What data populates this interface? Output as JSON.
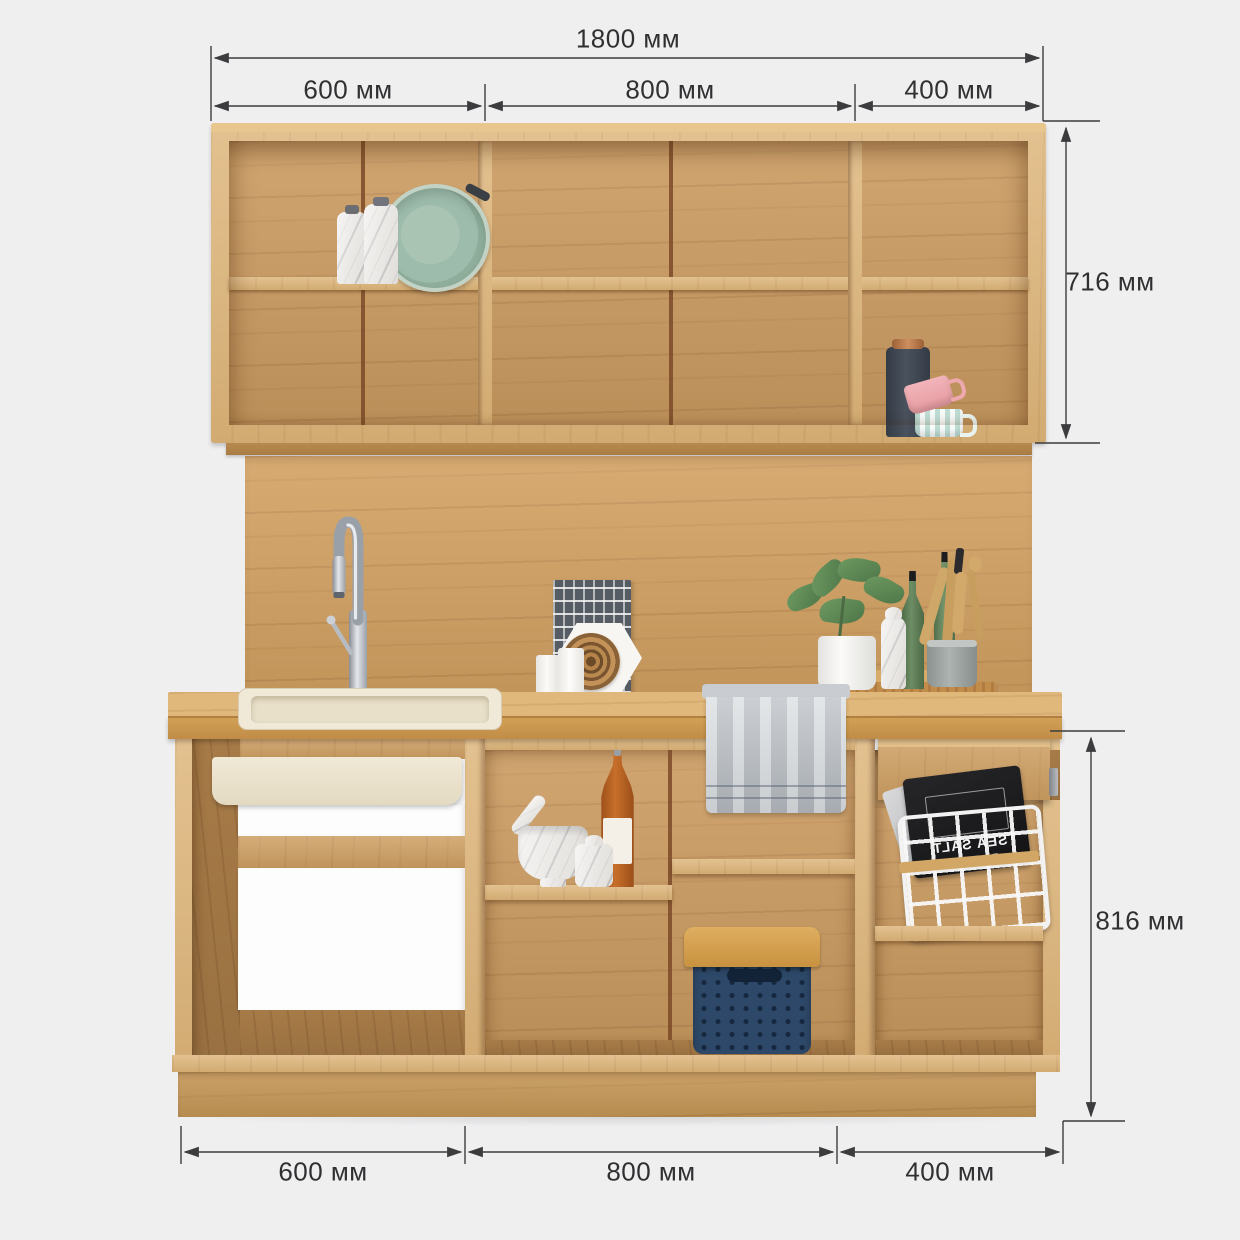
{
  "dimensions": {
    "top_total": "1800 мм",
    "top_segments": [
      "600 мм",
      "800 мм",
      "400 мм"
    ],
    "upper_cabinet_height": "716 мм",
    "base_cabinet_height": "816 мм",
    "bottom_segments": [
      "600 мм",
      "800 мм",
      "400 мм"
    ]
  },
  "packages": {
    "front_label": "SEA SALT",
    "back_label": "PEPPER"
  },
  "colors": {
    "background": "#efeff0",
    "dimension_lines": "#3c3c3e",
    "dimension_text": "#303032",
    "wood_mid": "#cfa063",
    "wood_light": "#ddb478",
    "wood_dark": "#b2834c",
    "wood_seam": "#7b4a28",
    "sink_cream": "#efe8d5",
    "drawer_white": "#fdfdfd",
    "towel_gray": "#c3c7cc",
    "basket_navy": "#2d4868",
    "basket_lid": "#d29e4b",
    "pan_green": "#9cb7a5",
    "mug_pink": "#efabb0",
    "mug_mint": "#bfddd5",
    "thermos_dark": "#3e4651",
    "copper": "#bd7c4f",
    "bottle_amber": "#aa5a1c",
    "bottle_green": "#5e7d57",
    "marble_white": "#ece9e5",
    "chrome": "#b7bcc2"
  }
}
